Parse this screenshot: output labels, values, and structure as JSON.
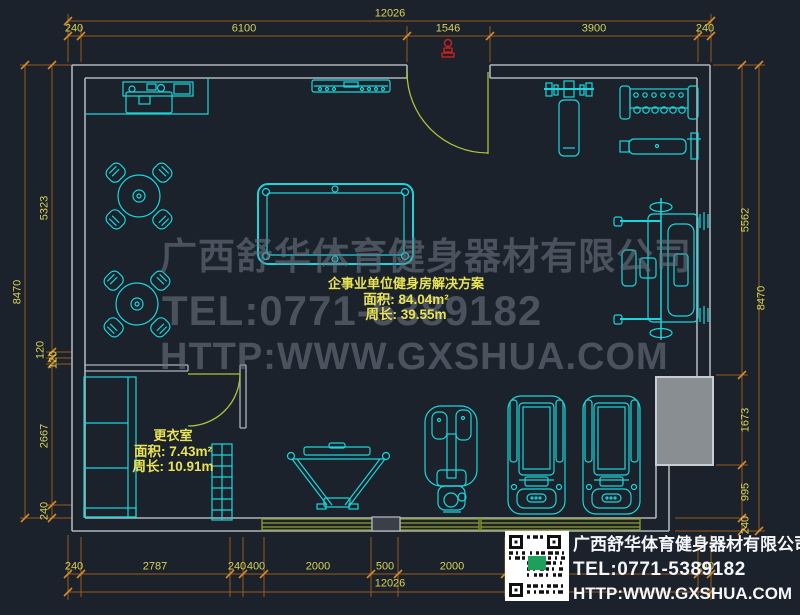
{
  "drawing": {
    "title": "企事业单位健身房解决方案",
    "area": "面积: 84.04m²",
    "perimeter": "周长: 39.55m"
  },
  "changing_room": {
    "name": "更衣室",
    "area": "面积: 7.43m²",
    "perimeter": "周长: 10.91m"
  },
  "watermark": {
    "company": "广西舒华体育健身器材有限公司",
    "tel": "TEL:0771-5389182",
    "website": "HTTP:WWW.GXSHUA.COM"
  },
  "logo": {
    "company": "广西舒华体育健身器材有限公司",
    "tel": "TEL:0771-5389182",
    "website": "HTTP:WWW.GXSHUA.COM"
  },
  "dimensions": {
    "top": {
      "total": "12026",
      "segments": [
        "240",
        "6100",
        "1546",
        "3900",
        "240"
      ]
    },
    "bottom": {
      "total": "12026",
      "segments": [
        "240",
        "2787",
        "240",
        "400",
        "2000",
        "500",
        "2000",
        "240"
      ]
    },
    "left": {
      "total": "8470",
      "segments": [
        "5323",
        "120",
        "120",
        "2667",
        "240"
      ]
    },
    "right": {
      "total": "8470",
      "segments": [
        "5562",
        "1673",
        "995",
        "240"
      ]
    }
  },
  "colors": {
    "background": "#1b222c",
    "wall": "#aeb4ba",
    "equipment_cyan": "#1ad6da",
    "dimension_line": "#9a5a1c",
    "dimension_text": "#d6d356",
    "label_yellow": "#e9e455",
    "door_green": "#a9c43c",
    "mat_olive": "#8f9e2f",
    "watermark_gray": "#6d7581",
    "block_gray": "#898e93",
    "marker_red": "#c2231f",
    "logo_text": "#f4f6f8"
  }
}
